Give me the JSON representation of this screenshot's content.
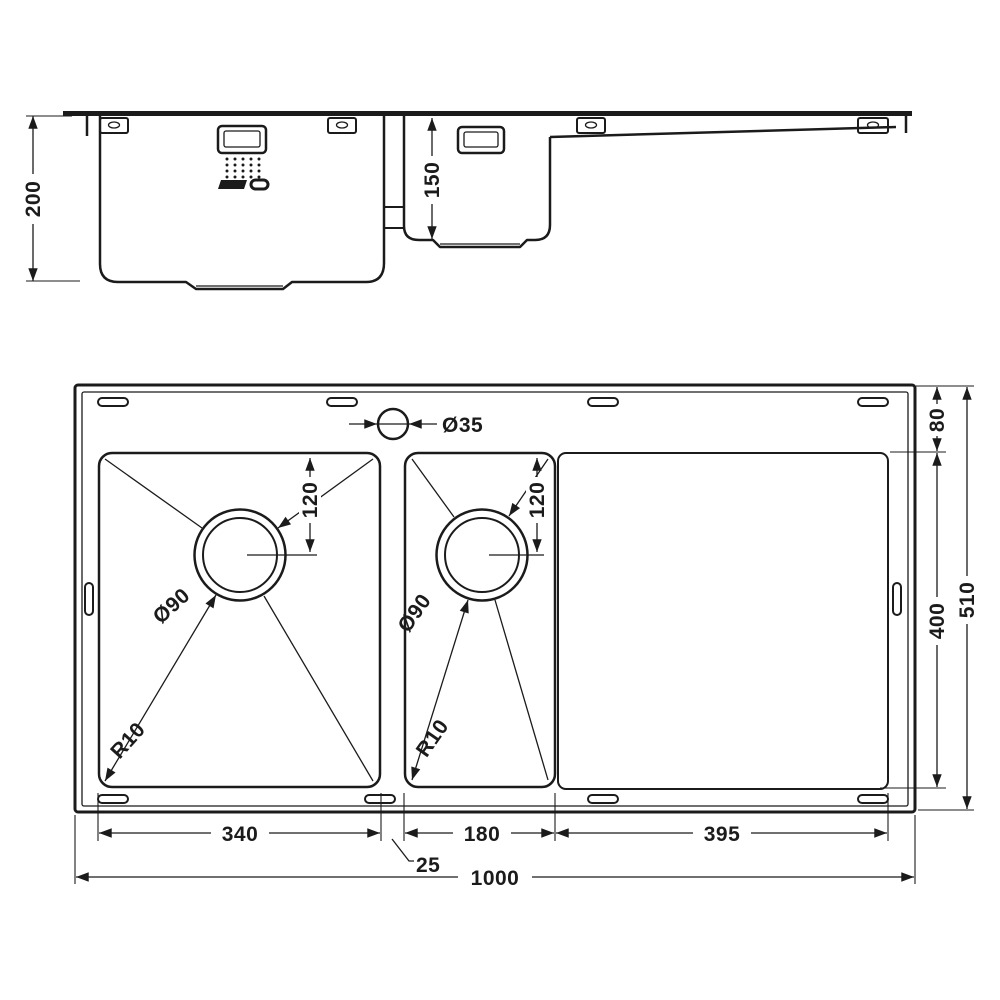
{
  "drawing": {
    "type": "technical-dimension-drawing",
    "subject": "kitchen sink, 1.5 bowls with drainer - side elevation and plan view",
    "line_color": "#1b1b1b",
    "background": "#ffffff",
    "labels": {
      "side_depth": "200",
      "bowl2_side_depth": "150",
      "tap_hole": "Ø35",
      "drain_bowl1": "Ø90",
      "drain_bowl2": "Ø90",
      "drain_offset_bowl1": "120",
      "drain_offset_bowl2": "120",
      "radius_bowl1": "R10",
      "radius_bowl2": "R10",
      "rim_to_bowls": "80",
      "bowls_depth": "400",
      "overall_depth": "510",
      "bowl1_width": "340",
      "divider": "25",
      "bowl2_width": "180",
      "drainer_width": "395",
      "overall_width": "1000"
    }
  }
}
